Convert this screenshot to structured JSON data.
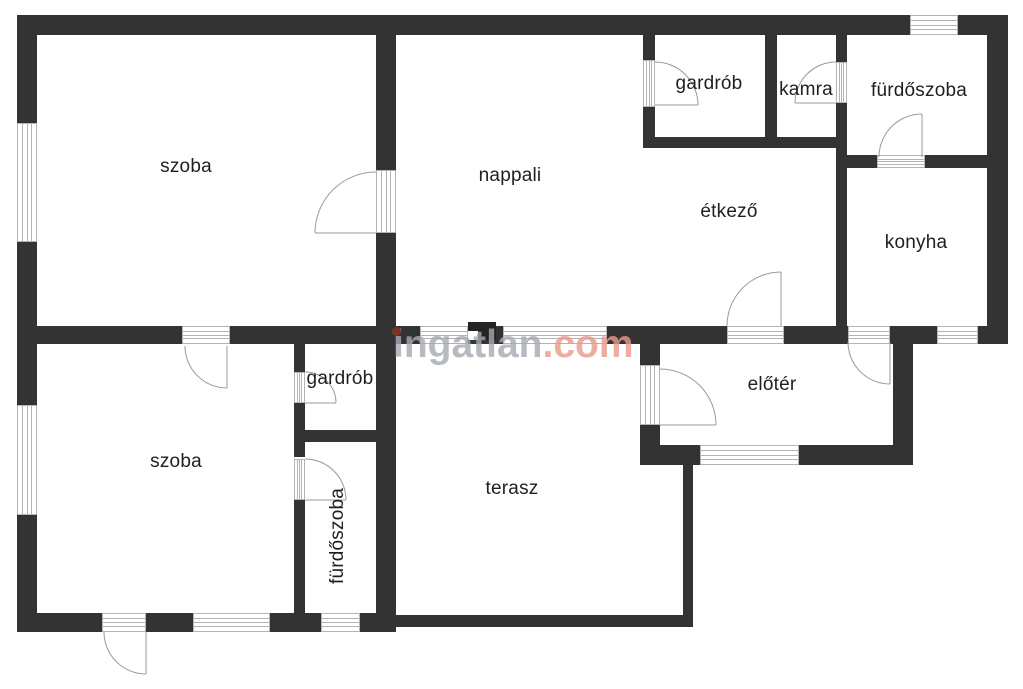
{
  "canvas": {
    "width": 1023,
    "height": 689,
    "bg": "#ffffff",
    "wall_color": "#333333",
    "frame_line_color": "#b3b3b3",
    "arc_color": "#999999",
    "label_color": "#1f1f1f"
  },
  "rooms": [
    {
      "id": "szoba-top",
      "label": "szoba",
      "x": 186,
      "y": 167,
      "rotate": 0
    },
    {
      "id": "nappali",
      "label": "nappali",
      "x": 510,
      "y": 176,
      "rotate": 0
    },
    {
      "id": "gardrob-top",
      "label": "gardrób",
      "x": 709,
      "y": 84,
      "rotate": 0
    },
    {
      "id": "kamra",
      "label": "kamra",
      "x": 806,
      "y": 90,
      "rotate": 0
    },
    {
      "id": "furdoszoba-top",
      "label": "fürdőszoba",
      "x": 919,
      "y": 91,
      "rotate": 0
    },
    {
      "id": "etkezo",
      "label": "étkező",
      "x": 729,
      "y": 212,
      "rotate": 0
    },
    {
      "id": "konyha",
      "label": "konyha",
      "x": 916,
      "y": 243,
      "rotate": 0
    },
    {
      "id": "szoba-bottom",
      "label": "szoba",
      "x": 176,
      "y": 462,
      "rotate": 0
    },
    {
      "id": "gardrob-bottom",
      "label": "gardrób",
      "x": 340,
      "y": 379,
      "rotate": 0
    },
    {
      "id": "furdoszoba-bottom",
      "label": "fürdőszoba",
      "x": 338,
      "y": 536,
      "rotate": -90
    },
    {
      "id": "terasz",
      "label": "terasz",
      "x": 512,
      "y": 489,
      "rotate": 0
    },
    {
      "id": "eloter",
      "label": "előtér",
      "x": 772,
      "y": 385,
      "rotate": 0
    }
  ],
  "walls": [
    {
      "id": "top-1",
      "x": 17,
      "y": 15,
      "w": 893,
      "h": 20
    },
    {
      "id": "top-2",
      "x": 958,
      "y": 15,
      "w": 50,
      "h": 20
    },
    {
      "id": "left-1",
      "x": 17,
      "y": 15,
      "w": 20,
      "h": 108
    },
    {
      "id": "left-2",
      "x": 17,
      "y": 242,
      "w": 20,
      "h": 163
    },
    {
      "id": "left-3",
      "x": 17,
      "y": 515,
      "w": 20,
      "h": 117
    },
    {
      "id": "bottom-1",
      "x": 17,
      "y": 613,
      "w": 85,
      "h": 19
    },
    {
      "id": "bottom-2",
      "x": 146,
      "y": 613,
      "w": 47,
      "h": 19
    },
    {
      "id": "bottom-3",
      "x": 270,
      "y": 613,
      "w": 51,
      "h": 19
    },
    {
      "id": "bottom-4",
      "x": 360,
      "y": 613,
      "w": 36,
      "h": 19
    },
    {
      "id": "right-1",
      "x": 987,
      "y": 15,
      "w": 21,
      "h": 327
    },
    {
      "id": "mid-1",
      "x": 17,
      "y": 326,
      "w": 165,
      "h": 18
    },
    {
      "id": "mid-2",
      "x": 230,
      "y": 326,
      "w": 190,
      "h": 18
    },
    {
      "id": "mid-3",
      "x": 468,
      "y": 326,
      "w": 35,
      "h": 18
    },
    {
      "id": "mid-4",
      "x": 607,
      "y": 326,
      "w": 120,
      "h": 18
    },
    {
      "id": "mid-5",
      "x": 784,
      "y": 326,
      "w": 64,
      "h": 18
    },
    {
      "id": "mid-6",
      "x": 890,
      "y": 326,
      "w": 47,
      "h": 18
    },
    {
      "id": "mid-7",
      "x": 978,
      "y": 326,
      "w": 30,
      "h": 18
    },
    {
      "id": "divider-v-1",
      "x": 376,
      "y": 35,
      "w": 20,
      "h": 135
    },
    {
      "id": "divider-v-2",
      "x": 376,
      "y": 233,
      "w": 20,
      "h": 380
    },
    {
      "id": "gardrob-left-1",
      "x": 643,
      "y": 35,
      "w": 12,
      "h": 25
    },
    {
      "id": "gardrob-left-2",
      "x": 643,
      "y": 107,
      "w": 12,
      "h": 41
    },
    {
      "id": "gardrob-kamra-div",
      "x": 765,
      "y": 35,
      "w": 12,
      "h": 113
    },
    {
      "id": "kamra-right-1",
      "x": 836,
      "y": 35,
      "w": 11,
      "h": 27
    },
    {
      "id": "kamra-right-2",
      "x": 836,
      "y": 103,
      "w": 11,
      "h": 45
    },
    {
      "id": "block-bottom",
      "x": 643,
      "y": 137,
      "w": 204,
      "h": 11
    },
    {
      "id": "furdo-bottom-1",
      "x": 847,
      "y": 155,
      "w": 30,
      "h": 13
    },
    {
      "id": "furdo-bottom-2",
      "x": 925,
      "y": 155,
      "w": 62,
      "h": 13
    },
    {
      "id": "konyha-left",
      "x": 836,
      "y": 148,
      "w": 11,
      "h": 196
    },
    {
      "id": "eloter-left-1",
      "x": 640,
      "y": 344,
      "w": 20,
      "h": 21
    },
    {
      "id": "eloter-left-2",
      "x": 640,
      "y": 425,
      "w": 20,
      "h": 20
    },
    {
      "id": "eloter-bottom-1",
      "x": 640,
      "y": 445,
      "w": 60,
      "h": 20
    },
    {
      "id": "eloter-bottom-2",
      "x": 799,
      "y": 445,
      "w": 114,
      "h": 20
    },
    {
      "id": "eloter-right",
      "x": 893,
      "y": 342,
      "w": 20,
      "h": 123
    },
    {
      "id": "terasz-right",
      "x": 683,
      "y": 463,
      "w": 10,
      "h": 164
    },
    {
      "id": "terasz-bottom",
      "x": 396,
      "y": 615,
      "w": 297,
      "h": 12
    },
    {
      "id": "bg-left-1",
      "x": 294,
      "y": 344,
      "w": 11,
      "h": 28
    },
    {
      "id": "bg-left-2",
      "x": 294,
      "y": 403,
      "w": 11,
      "h": 54
    },
    {
      "id": "bg-left-3",
      "x": 294,
      "y": 500,
      "w": 11,
      "h": 113
    },
    {
      "id": "bg-divider",
      "x": 294,
      "y": 430,
      "w": 102,
      "h": 12
    }
  ],
  "pillar": {
    "x": 468,
    "y": 322,
    "w": 28,
    "h": 18,
    "notch": {
      "x": 468,
      "y": 331,
      "w": 10,
      "h": 9
    }
  },
  "openings": [
    {
      "id": "window-top-furdo",
      "kind": "window",
      "orient": "h",
      "x": 910,
      "y": 15,
      "w": 48,
      "h": 20
    },
    {
      "id": "window-nappali-terasz-1",
      "kind": "window",
      "orient": "h",
      "x": 420,
      "y": 326,
      "w": 48,
      "h": 18
    },
    {
      "id": "window-nappali-terasz-2",
      "kind": "window",
      "orient": "h",
      "x": 503,
      "y": 326,
      "w": 104,
      "h": 18
    },
    {
      "id": "window-konyha",
      "kind": "window",
      "orient": "h",
      "x": 937,
      "y": 326,
      "w": 41,
      "h": 18
    },
    {
      "id": "window-eloter",
      "kind": "window",
      "orient": "h",
      "x": 700,
      "y": 445,
      "w": 99,
      "h": 20
    },
    {
      "id": "window-szoba-bottom-1",
      "kind": "window",
      "orient": "h",
      "x": 193,
      "y": 613,
      "w": 77,
      "h": 19
    },
    {
      "id": "window-furdo-bottom",
      "kind": "window",
      "orient": "h",
      "x": 321,
      "y": 613,
      "w": 39,
      "h": 19
    },
    {
      "id": "window-szoba-top-left",
      "kind": "window",
      "orient": "v",
      "x": 17,
      "y": 123,
      "w": 20,
      "h": 119
    },
    {
      "id": "window-szoba-bottom-left",
      "kind": "window",
      "orient": "v",
      "x": 17,
      "y": 405,
      "w": 20,
      "h": 110
    },
    {
      "id": "door-szoba-nappali",
      "kind": "door",
      "orient": "v",
      "x": 376,
      "y": 170,
      "w": 20,
      "h": 63
    },
    {
      "id": "door-nappali-gardrob",
      "kind": "door",
      "orient": "v",
      "x": 643,
      "y": 60,
      "w": 12,
      "h": 47
    },
    {
      "id": "door-furdo-kamra",
      "kind": "door",
      "orient": "v",
      "x": 836,
      "y": 62,
      "w": 11,
      "h": 41
    },
    {
      "id": "door-furdo-konyha",
      "kind": "door",
      "orient": "h",
      "x": 877,
      "y": 155,
      "w": 48,
      "h": 13
    },
    {
      "id": "door-etkezo-eloter",
      "kind": "door",
      "orient": "h",
      "x": 727,
      "y": 326,
      "w": 57,
      "h": 18
    },
    {
      "id": "door-konyha-eloter",
      "kind": "door",
      "orient": "h",
      "x": 848,
      "y": 326,
      "w": 42,
      "h": 18
    },
    {
      "id": "door-terasz-eloter",
      "kind": "door",
      "orient": "v",
      "x": 640,
      "y": 365,
      "w": 20,
      "h": 60
    },
    {
      "id": "door-szoba-szoba",
      "kind": "door",
      "orient": "h",
      "x": 182,
      "y": 326,
      "w": 48,
      "h": 18
    },
    {
      "id": "door-szoba-gardrob-b",
      "kind": "door",
      "orient": "v",
      "x": 294,
      "y": 372,
      "w": 11,
      "h": 31
    },
    {
      "id": "door-szoba-furdo-b",
      "kind": "door",
      "orient": "v",
      "x": 294,
      "y": 459,
      "w": 11,
      "h": 41
    },
    {
      "id": "door-szoba-exterior",
      "kind": "door",
      "orient": "h",
      "x": 102,
      "y": 613,
      "w": 44,
      "h": 19
    }
  ],
  "door_arcs": [
    {
      "id": "arc-szoba-nappali",
      "path": "M376,172 A61,61 0 0 0 315,233",
      "leaf": [
        315,
        233,
        376,
        233
      ]
    },
    {
      "id": "arc-nappali-gardrob",
      "path": "M655,62 A43,43 0 0 1 698,105",
      "leaf": [
        655,
        105,
        698,
        105
      ]
    },
    {
      "id": "arc-furdo-kamra",
      "path": "M836,62 A41,41 0 0 0 795,103",
      "leaf": [
        795,
        103,
        836,
        103
      ]
    },
    {
      "id": "arc-furdo-konyha",
      "path": "M879,157 A43,43 0 0 1 922,114",
      "leaf": [
        922,
        114,
        922,
        157
      ]
    },
    {
      "id": "arc-etkezo-eloter",
      "path": "M727,326 A54,54 0 0 1 781,272",
      "leaf": [
        781,
        272,
        781,
        326
      ]
    },
    {
      "id": "arc-konyha-eloter",
      "path": "M848,342 A42,42 0 0 0 890,384",
      "leaf": [
        890,
        342,
        890,
        384
      ]
    },
    {
      "id": "arc-terasz-eloter",
      "path": "M660,369 A56,56 0 0 1 716,425",
      "leaf": [
        660,
        425,
        716,
        425
      ]
    },
    {
      "id": "arc-szoba-szoba",
      "path": "M185,346 A42,42 0 0 0 227,388",
      "leaf": [
        227,
        346,
        227,
        388
      ]
    },
    {
      "id": "arc-szoba-gardrob-b",
      "path": "M305,372 A31,31 0 0 1 336,403",
      "leaf": [
        305,
        403,
        336,
        403
      ]
    },
    {
      "id": "arc-szoba-furdo-b",
      "path": "M305,459 A41,41 0 0 1 346,500",
      "leaf": [
        305,
        500,
        346,
        500
      ]
    },
    {
      "id": "arc-szoba-exterior",
      "path": "M104,632 A42,42 0 0 0 146,674",
      "leaf": [
        146,
        632,
        146,
        674
      ]
    }
  ],
  "watermark": {
    "main": "ingatlan",
    "suffix": ".com",
    "main_color": "#a6aab2",
    "suffix_color": "#e9998c",
    "dot_color": "#7b3423",
    "x": 393,
    "y": 325,
    "font_size": 39,
    "dot": {
      "x": 392,
      "y": 327,
      "r": 4.5
    }
  }
}
